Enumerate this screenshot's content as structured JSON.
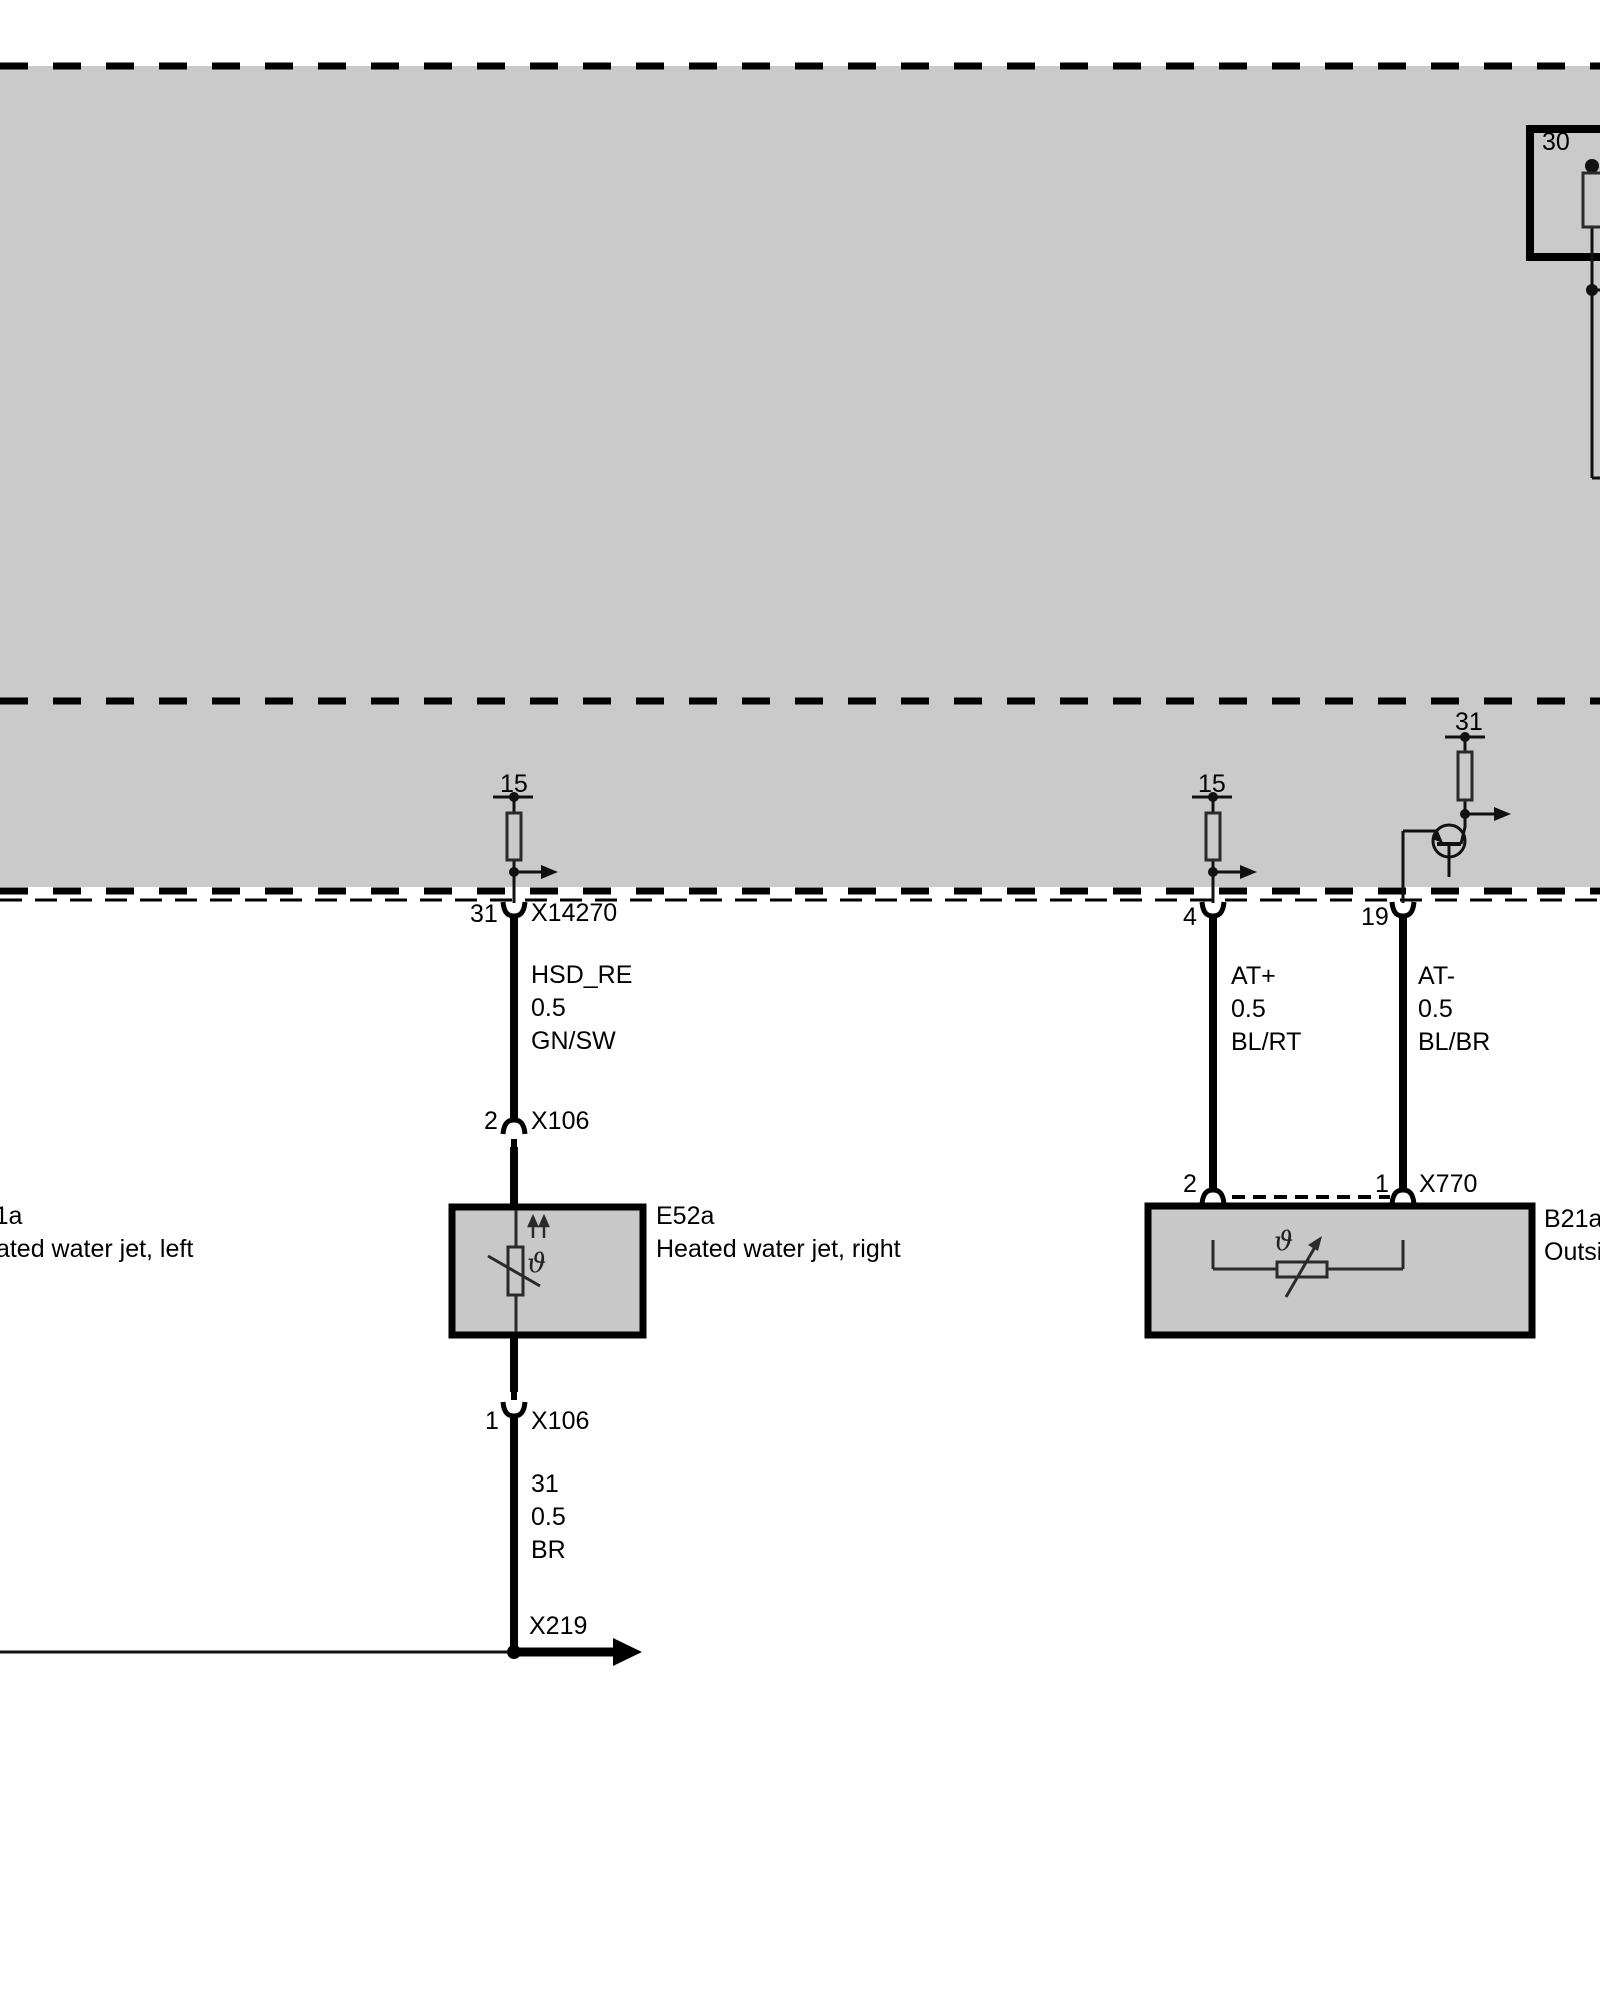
{
  "colors": {
    "background": "#ffffff",
    "module_gray": "#cacaca",
    "component_gray": "#c8c8c8",
    "line_black": "#000000",
    "inner_stroke": "#2a2a2a"
  },
  "terminals": {
    "kl30": "30",
    "kl15_left": "15",
    "kl15_right": "15",
    "kl31": "31"
  },
  "left_circuit": {
    "pin_31": "31",
    "connector_top": "X14270",
    "wire_signal": {
      "name": "HSD_RE",
      "size": "0.5",
      "color": "GN/SW"
    },
    "pin_2": "2",
    "connector_mid": "X106",
    "component_code": "E52a",
    "component_desc": "Heated water jet, right",
    "theta_symbol": "ϑ",
    "pin_1": "1",
    "connector_bottom": "X106",
    "wire_ground": {
      "name": "31",
      "size": "0.5",
      "color": "BR"
    },
    "ground_connector": "X219"
  },
  "left_offscreen_component": {
    "component_code": "E51a",
    "component_desc": "Heated water jet, left"
  },
  "right_circuit": {
    "pin_4": "4",
    "pin_19": "19",
    "wire_at_plus": {
      "name": "AT+",
      "size": "0.5",
      "color": "BL/RT"
    },
    "wire_at_minus": {
      "name": "AT-",
      "size": "0.5",
      "color": "BL/BR"
    },
    "pin_2": "2",
    "pin_1": "1",
    "connector": "X770",
    "component_code": "B21a",
    "component_desc": "Outside temperature sensor",
    "theta_symbol": "ϑ"
  }
}
